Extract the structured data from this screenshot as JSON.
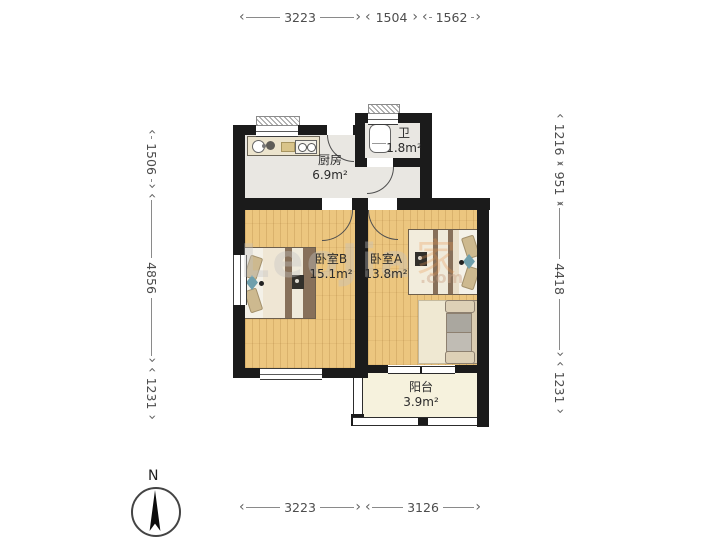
{
  "floorplan": {
    "rooms": {
      "kitchen": {
        "name": "厨房",
        "area": "6.9m²"
      },
      "bathroom": {
        "name": "卫",
        "area": "1.8m²"
      },
      "bedroom_b": {
        "name": "卧室B",
        "area": "15.1m²"
      },
      "bedroom_a": {
        "name": "卧室A",
        "area": "13.8m²"
      },
      "balcony": {
        "name": "阳台",
        "area": "3.9m²"
      }
    },
    "dimensions_mm": {
      "top": [
        "3223",
        "1504",
        "1562"
      ],
      "bottom": [
        "3223",
        "3126"
      ],
      "left": [
        "1506",
        "4856",
        "1231"
      ],
      "right": [
        "1216",
        "951",
        "4418",
        "1231"
      ]
    },
    "compass": {
      "north_label": "N"
    },
    "watermark": {
      "latin": "LeoJia",
      "cn": "家",
      "suffix": ".com"
    },
    "colors": {
      "wall": "#1b1b1b",
      "wood_floor": "#ecc67f",
      "tile_floor": "#e9e7e2",
      "balcony_floor": "#f6f2dd",
      "bed_brown": "#87705a"
    }
  }
}
